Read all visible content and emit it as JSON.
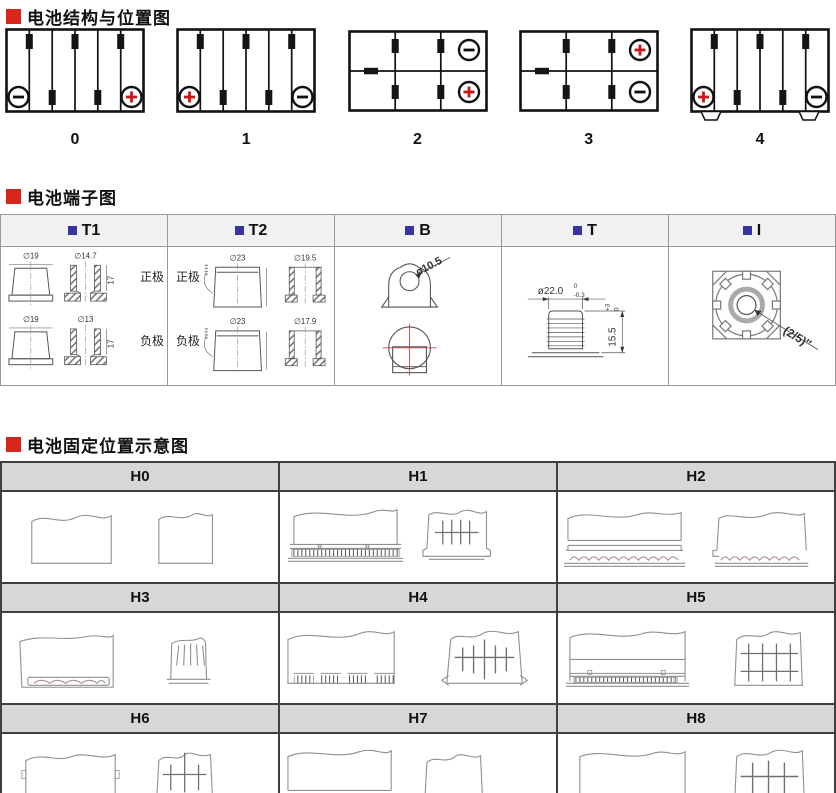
{
  "sections": {
    "structure": {
      "title": "电池结构与位置图",
      "diagrams": [
        {
          "label": "0",
          "cells": "1x6",
          "neg": "bottom-left",
          "pos": "bottom-right"
        },
        {
          "label": "1",
          "cells": "1x6",
          "pos": "bottom-left",
          "neg": "bottom-right"
        },
        {
          "label": "2",
          "cells": "2x3",
          "neg": "top-right",
          "pos": "bottom-right"
        },
        {
          "label": "3",
          "cells": "2x3",
          "pos": "top-right",
          "neg": "bottom-right"
        },
        {
          "label": "4",
          "cells": "1x6",
          "pos": "bottom-left",
          "neg": "bottom-right",
          "mounting_feet": true
        }
      ]
    },
    "terminals": {
      "title": "电池端子图",
      "columns": [
        {
          "label": "T1",
          "pos_label": "正极",
          "neg_label": "负极",
          "pos_outer_dia": "∅19",
          "pos_inner_dia": "∅14.7",
          "pos_height": "17",
          "neg_outer_dia": "∅19",
          "neg_inner_dia": "∅13",
          "neg_height": "17"
        },
        {
          "label": "T2",
          "pos_label": "正极",
          "neg_label": "负极",
          "pos_outer_dia": "∅23",
          "pos_inner_dia": "∅19.5",
          "neg_outer_dia": "∅23",
          "neg_inner_dia": "∅17.9"
        },
        {
          "label": "B",
          "hole_dia": "ø10.5"
        },
        {
          "label": "T",
          "stud_dia": "ø22.0",
          "stud_tol_upper": "0",
          "stud_tol_lower": "-0.3",
          "stud_height": "15.5",
          "height_tol_upper": "+3",
          "height_tol_lower": "0"
        },
        {
          "label": "I",
          "thread_size": "(2/5)″"
        }
      ]
    },
    "holddown": {
      "title": "电池固定位置示意图",
      "cells": [
        {
          "label": "H0"
        },
        {
          "label": "H1"
        },
        {
          "label": "H2"
        },
        {
          "label": "H3"
        },
        {
          "label": "H4"
        },
        {
          "label": "H5"
        },
        {
          "label": "H6"
        },
        {
          "label": "H7"
        },
        {
          "label": "H8"
        }
      ]
    }
  },
  "colors": {
    "accent_red": "#d9261c",
    "accent_navy": "#35359b",
    "plus_red": "#cb1616"
  }
}
